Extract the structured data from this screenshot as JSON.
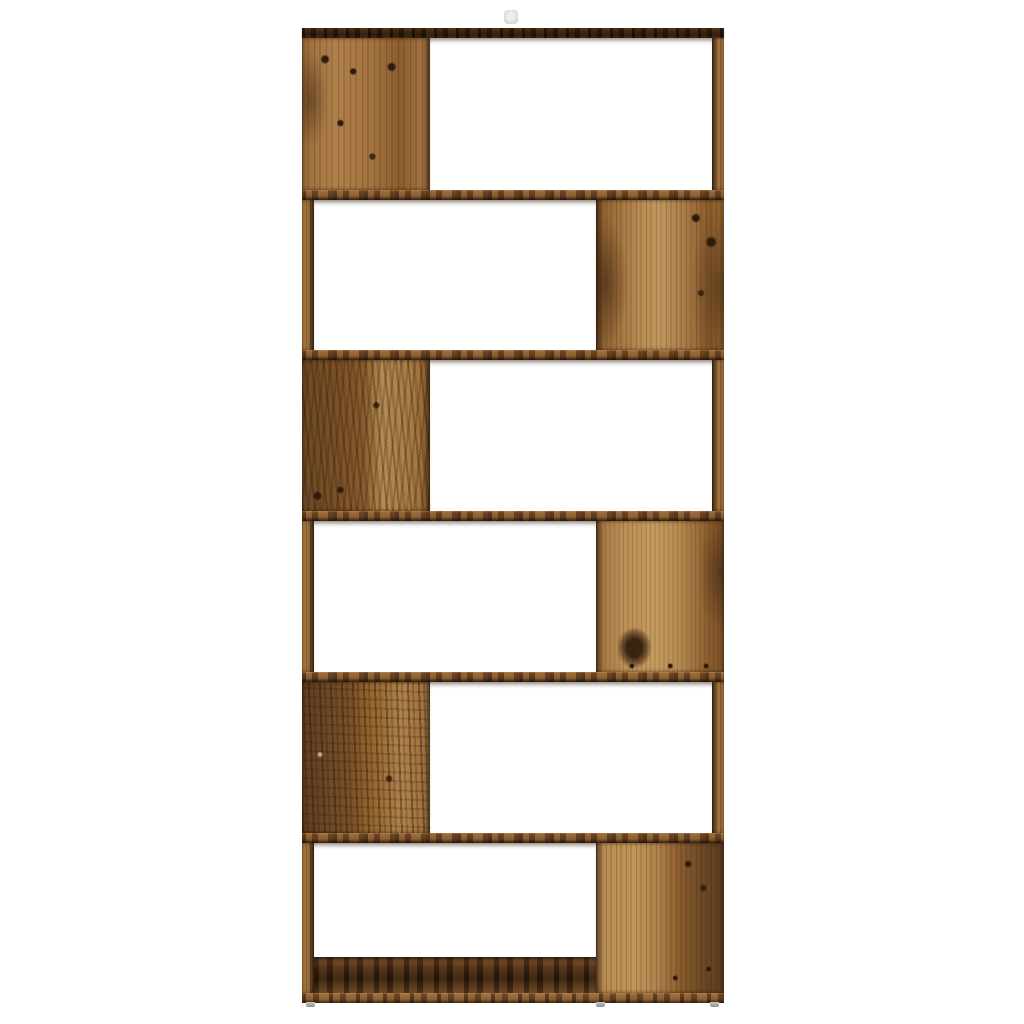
{
  "page": {
    "content_type": "product-photo",
    "visible_text": ""
  },
  "product": {
    "name": "rustic-zigzag-bookcase-room-divider",
    "material_style": "aged reclaimed wood with knots and dark streaks",
    "tier_count": 6,
    "tiers": [
      {
        "index": 1,
        "divider_panel_side": "left",
        "opening_side": "right"
      },
      {
        "index": 2,
        "divider_panel_side": "right",
        "opening_side": "left"
      },
      {
        "index": 3,
        "divider_panel_side": "left",
        "opening_side": "right"
      },
      {
        "index": 4,
        "divider_panel_side": "right",
        "opening_side": "left"
      },
      {
        "index": 5,
        "divider_panel_side": "left",
        "opening_side": "right"
      },
      {
        "index": 6,
        "divider_panel_side": "right",
        "opening_side": "left"
      }
    ],
    "feet_count": 3,
    "wall_mount_tab_visible": true
  },
  "colors": {
    "background": "#ffffff",
    "wood_light": "#c0965c",
    "wood_mid": "#a3743f",
    "wood_dark": "#6e4a26",
    "wood_deep": "#3a2312",
    "knot": "#2e1a0c",
    "foot_gray": "#a8a8a8",
    "tab_gray": "#dcdad8"
  }
}
